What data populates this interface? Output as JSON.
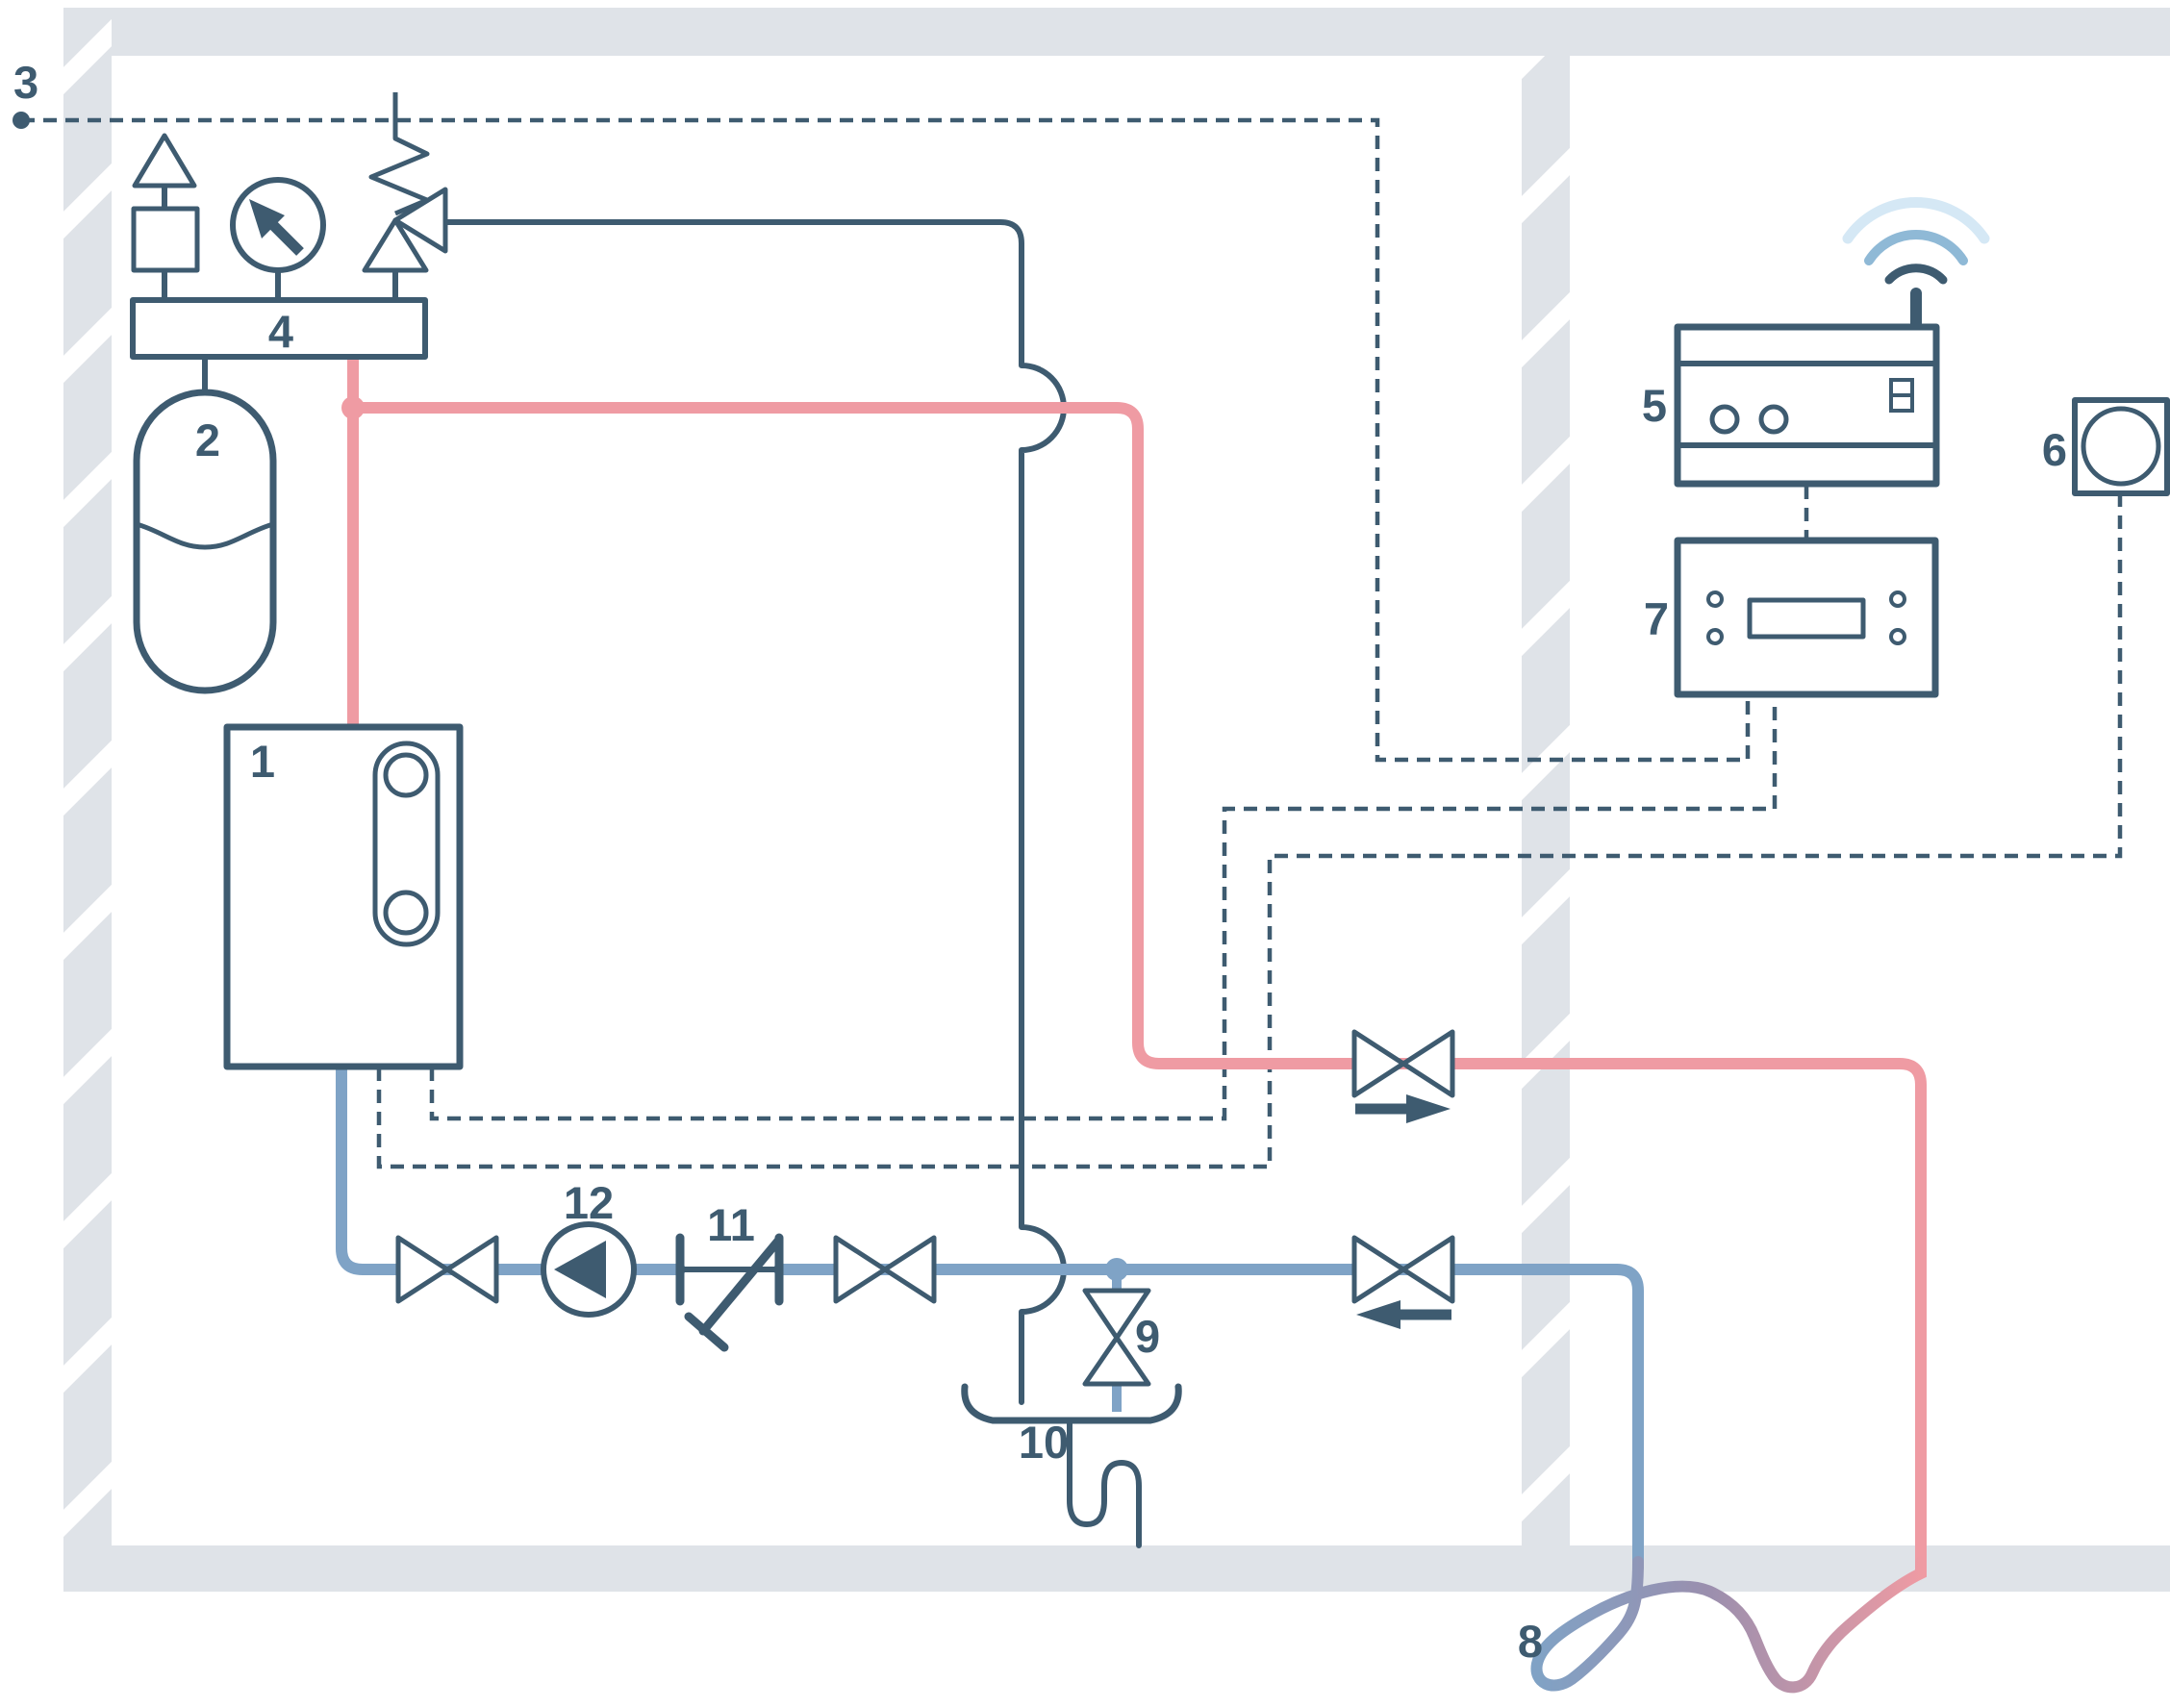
{
  "diagram": {
    "type": "heating-system-piping-schematic",
    "component_labels": {
      "heat_generator": "1",
      "expansion_vessel": "2",
      "outdoor_sensor": "3",
      "safety_group": "4",
      "wireless_gateway": "5",
      "room_sensor": "6",
      "room_controller": "7",
      "underfloor_heating_loop": "8",
      "drain_valve": "9",
      "drain_funnel": "10",
      "check_valve": "11",
      "circulation_pump": "12"
    },
    "icons": {
      "air_vent": "air-vent-icon",
      "pressure_gauge": "pressure-gauge-icon",
      "safety_relief_valve": "safety-relief-valve-icon",
      "shutoff_valve": "shutoff-valve-icon",
      "flow_arrow_supply": "arrow-right-icon",
      "flow_arrow_return": "arrow-left-icon",
      "wifi": "wifi-signal-icon",
      "antenna": "antenna-icon",
      "siphon_trap": "siphon-trap-icon"
    },
    "colors": {
      "line_dark": "#3e5b70",
      "pipe_hot": "#ef9ba3",
      "pipe_cold": "#7fa3c6",
      "loop_mid": "#9a8fae",
      "wall": "#dfe3e8",
      "wifi_mid": "#8fb9d6",
      "wifi_light": "#d5e8f5",
      "background": "#ffffff"
    }
  }
}
